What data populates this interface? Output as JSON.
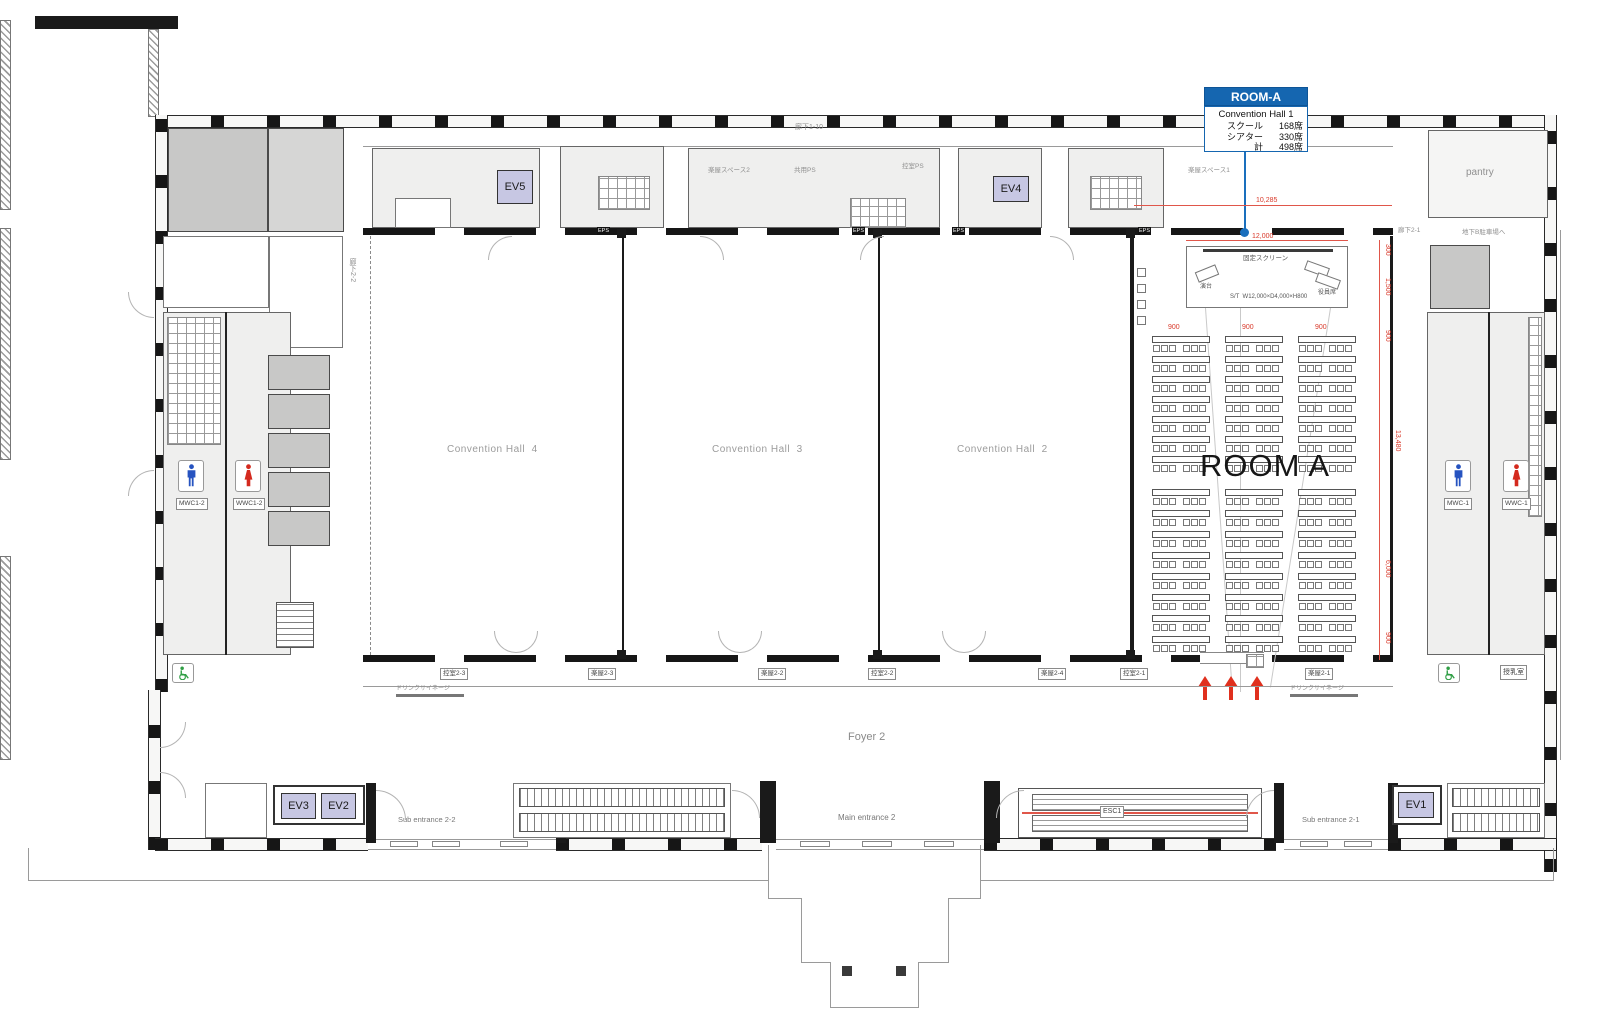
{
  "callout": {
    "title": "ROOM-A",
    "subtitle": "Convention Hall 1",
    "rows": [
      {
        "k": "スクール",
        "v": "168席"
      },
      {
        "k": "シアター",
        "v": "330席"
      },
      {
        "k": "計",
        "v": "498席"
      }
    ]
  },
  "halls": {
    "hall4": "Convention Hall  4",
    "hall3": "Convention Hall  3",
    "hall2": "Convention Hall  2",
    "room_a": "ROOM A"
  },
  "stage": {
    "screen": "固定スクリーン",
    "podium": "演台",
    "size": "S/T  W12,000×D4,000×H800",
    "exec": "役員席"
  },
  "dims": {
    "w12000": "12,000",
    "w10285": "10,285",
    "p900a": "900",
    "p900b": "900",
    "p900c": "900",
    "r300": "300",
    "r1500": "1,500",
    "r900a": "900",
    "r13480": "13,480",
    "r6000": "6,000",
    "r900b": "900"
  },
  "elevators": {
    "ev1": "EV1",
    "ev2": "EV2",
    "ev3": "EV3",
    "ev4": "EV4",
    "ev5": "EV5"
  },
  "toilets": {
    "left_m": "MWC1-2",
    "left_w": "WWC1-2",
    "right_m": "MWC-1",
    "right_w": "WWC-1"
  },
  "entrances": {
    "sub22": "Sub entrance 2-2",
    "main2": "Main entrance 2",
    "sub21": "Sub entrance 2-1",
    "esc1": "ESC1"
  },
  "foyer": "Foyer 2",
  "rooms": {
    "pantry": "pantry",
    "nursing": "授乳室",
    "backstage1": "楽屋スペース1",
    "backstage2": "楽屋スペース2",
    "backstage3": "楽屋スペース",
    "corridor110": "廊下1-10",
    "corridor22": "廊下2-2",
    "corridor21": "廊下2-1",
    "kyoyo_ps": "共用PS",
    "hikae_ps": "控室PS",
    "eps": "EPS",
    "drink": "ドリンクサイネージ",
    "basement": "地下B駐車場へ",
    "small": [
      "控室2-3",
      "楽屋2-3",
      "楽屋2-2",
      "控室2-2",
      "楽屋2-4",
      "控室2-1",
      "楽屋2-1"
    ]
  },
  "seating": {
    "columns": 3,
    "col_x": [
      1152,
      1225,
      1298
    ],
    "table_w": 58,
    "table_h": 7,
    "upper_rows": 7,
    "upper_y": 336,
    "upper_pitch": 20,
    "lower_rows": 8,
    "lower_y": 489,
    "lower_pitch": 21,
    "chair_offsets": [
      1,
      9,
      17,
      31,
      39,
      47
    ],
    "side_chairs": 4,
    "side_x": 1137,
    "side_y": 268,
    "side_pitch": 16
  }
}
